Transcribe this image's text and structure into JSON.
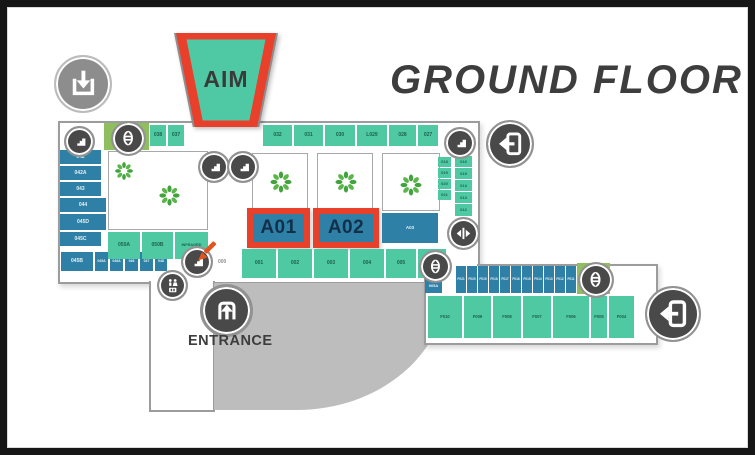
{
  "title": "GROUND FLOOR",
  "aim": {
    "label": "AIM"
  },
  "entrance": {
    "label": "ENTRANCE"
  },
  "you_are_here": {
    "label": "000"
  },
  "map": {
    "top_left_rooms": [
      "038",
      "037"
    ],
    "top_row": [
      "032",
      "031",
      "030",
      "L029",
      "028",
      "027"
    ],
    "left_column": [
      "042",
      "042A",
      "043",
      "044",
      "045D",
      "045C"
    ],
    "left_bottom_row": [
      "045B",
      "045A",
      "046A",
      "046",
      "047",
      "048"
    ],
    "mid_left_rooms": [
      "050A",
      "050B",
      "INFRAGRD"
    ],
    "right_inner_column": [
      "018",
      "019",
      "020",
      "021"
    ],
    "right_outer_column": [
      "016",
      "015",
      "014",
      "013",
      "012"
    ],
    "highlight_units": [
      "A01",
      "A02"
    ],
    "unit_a03": "A03",
    "bottom_row": [
      "001",
      "002",
      "003",
      "004",
      "005"
    ],
    "room_005a": "005A",
    "wing_blue_row": [
      "F021",
      "F020",
      "F019",
      "F018",
      "F017",
      "F016",
      "F015",
      "F014",
      "F013",
      "F012",
      "F011"
    ],
    "wing_green_row": [
      "F010",
      "F009",
      "F008",
      "F007",
      "F006",
      "F005",
      "F004"
    ]
  },
  "icons": [
    "exit-down-icon",
    "stairs-icon",
    "elevator-icon",
    "restroom-icon",
    "lift-doors-icon",
    "door-exit-icon",
    "entrance-icon",
    "you-are-here-arrow-icon",
    "plant-icon"
  ],
  "colors": {
    "unit_teal": "#4ec9a2",
    "unit_blue": "#2f80a7",
    "elevator_green": "#8fbe5f",
    "highlight_red": "#e8402b",
    "parking_gray": "#bdbdbd",
    "icon_dark": "#494949",
    "title_text": "#3d3d3d"
  }
}
